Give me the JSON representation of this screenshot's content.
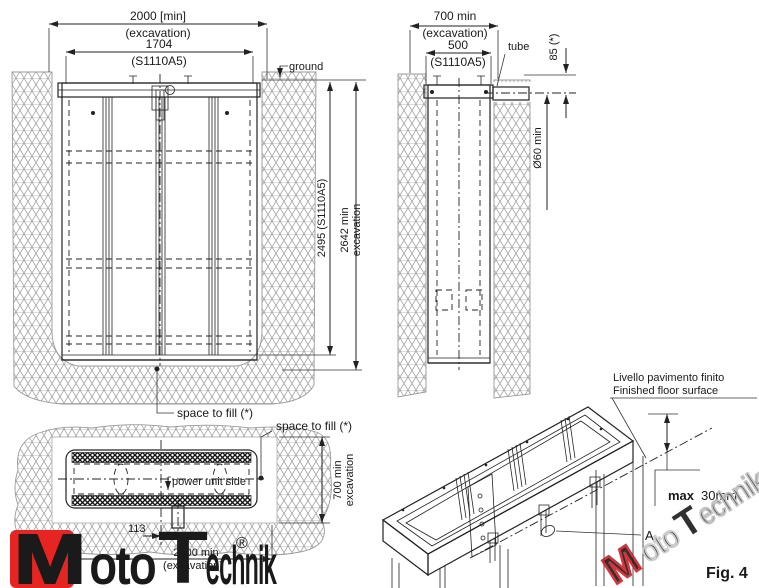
{
  "front_view": {
    "dim_2000": "2000  [min]",
    "dim_2000_sub": "(excavation)",
    "dim_1704": "1704",
    "dim_1704_sub": "(S1110A5)",
    "ground": "ground",
    "dim_2495": "2495  (S1110A5)",
    "dim_2642_l1": "2642  min",
    "dim_2642_l2": "excavation",
    "space_to_fill": "space to fill (*)"
  },
  "side_view": {
    "dim_700": "700  min",
    "dim_700_sub": "(excavation)",
    "dim_500": "500",
    "dim_500_sub": "(S1110A5)",
    "tube": "tube",
    "dim_85": "85  (*)",
    "dim_60": "Ø60 min"
  },
  "top_view": {
    "space_to_fill": "space to fill (*)",
    "power_unit": "power unit side",
    "dim_700_l1": "700  min",
    "dim_700_l2": "excavation",
    "dim_113": "113",
    "dim_2000_l1": "2000  min",
    "dim_2000_l2": "(excavation)"
  },
  "iso_view": {
    "floor_label_it": "Livello pavimento finito",
    "floor_label_en": "Finished floor surface",
    "max_bold": "max",
    "max_value": "30mm",
    "detail": "A",
    "fig": "Fig. 4"
  },
  "logo": {
    "m": "M",
    "oto": "oto",
    "t": "T",
    "echnik": "echnik",
    "reg": "®"
  },
  "watermark": {
    "m": "M",
    "oto": "oto",
    "t": "T",
    "rest": "echnik.pl"
  },
  "colors": {
    "line": "#222222",
    "soil_hatch": "#9a9a9a",
    "logo_red": "#e62421",
    "watermark_red": "#cf2028",
    "watermark_gray": "#bdbdbd"
  }
}
